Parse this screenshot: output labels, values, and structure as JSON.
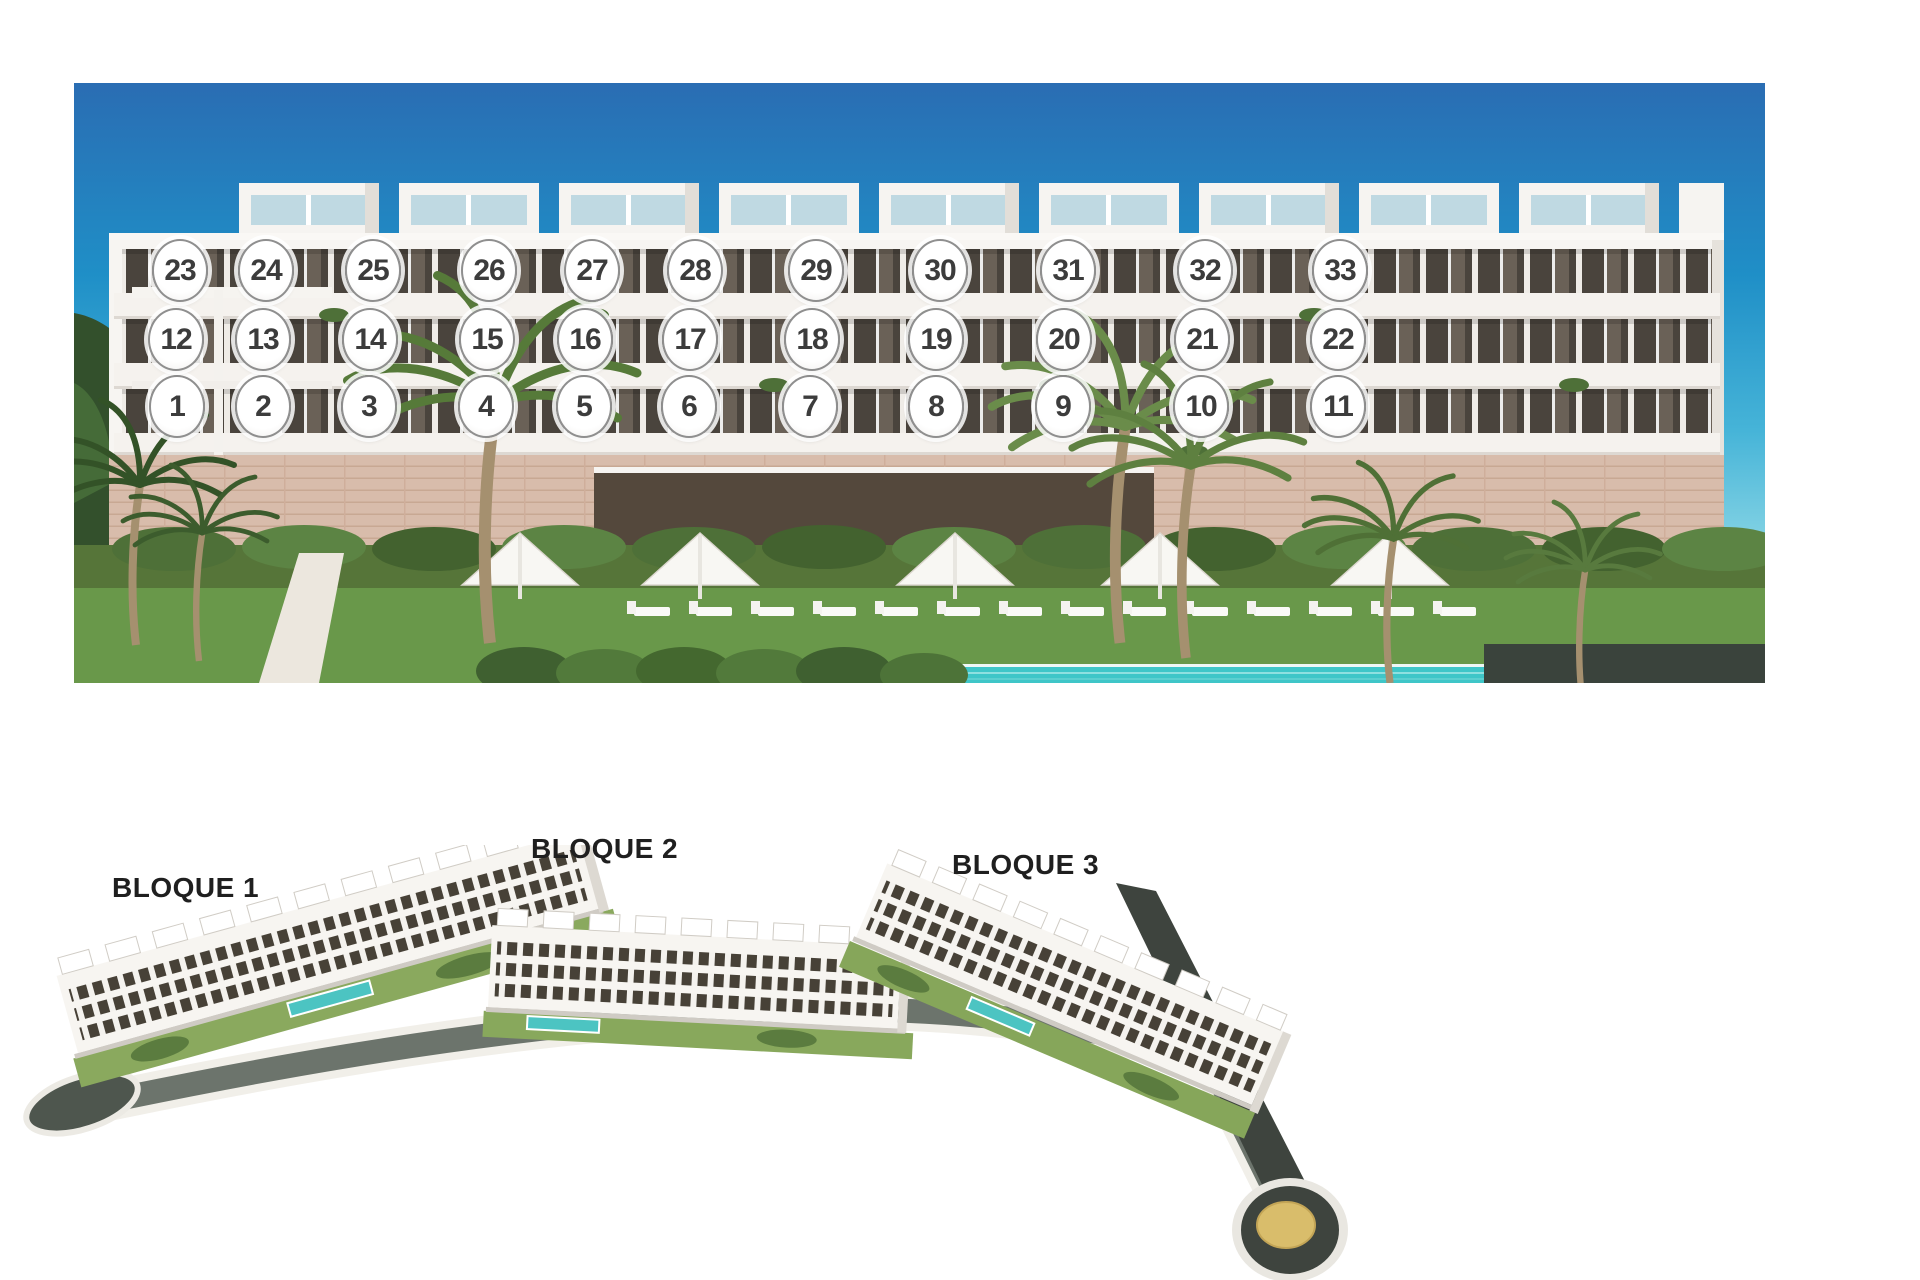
{
  "page": {
    "background_color": "#ffffff"
  },
  "front_elevation": {
    "description": "Front render of apartment block with numbered unit markers",
    "rows": {
      "top_floor_units": "23-33",
      "middle_floor_units": "12-22",
      "ground_floor_units": "1-11"
    },
    "units": [
      {
        "n": "1",
        "x": 177,
        "y": 407
      },
      {
        "n": "2",
        "x": 263,
        "y": 407
      },
      {
        "n": "3",
        "x": 369,
        "y": 407
      },
      {
        "n": "4",
        "x": 486,
        "y": 407
      },
      {
        "n": "5",
        "x": 584,
        "y": 407
      },
      {
        "n": "6",
        "x": 689,
        "y": 407
      },
      {
        "n": "7",
        "x": 810,
        "y": 407
      },
      {
        "n": "8",
        "x": 936,
        "y": 407
      },
      {
        "n": "9",
        "x": 1063,
        "y": 407
      },
      {
        "n": "10",
        "x": 1201,
        "y": 407
      },
      {
        "n": "11",
        "x": 1338,
        "y": 407
      },
      {
        "n": "12",
        "x": 176,
        "y": 340
      },
      {
        "n": "13",
        "x": 263,
        "y": 340
      },
      {
        "n": "14",
        "x": 370,
        "y": 340
      },
      {
        "n": "15",
        "x": 487,
        "y": 340
      },
      {
        "n": "16",
        "x": 585,
        "y": 340
      },
      {
        "n": "17",
        "x": 690,
        "y": 340
      },
      {
        "n": "18",
        "x": 812,
        "y": 340
      },
      {
        "n": "19",
        "x": 936,
        "y": 340
      },
      {
        "n": "20",
        "x": 1064,
        "y": 340
      },
      {
        "n": "21",
        "x": 1202,
        "y": 340
      },
      {
        "n": "22",
        "x": 1338,
        "y": 340
      },
      {
        "n": "23",
        "x": 180,
        "y": 271
      },
      {
        "n": "24",
        "x": 266,
        "y": 271
      },
      {
        "n": "25",
        "x": 373,
        "y": 271
      },
      {
        "n": "26",
        "x": 489,
        "y": 271
      },
      {
        "n": "27",
        "x": 592,
        "y": 271
      },
      {
        "n": "28",
        "x": 695,
        "y": 271
      },
      {
        "n": "29",
        "x": 816,
        "y": 271
      },
      {
        "n": "30",
        "x": 940,
        "y": 271
      },
      {
        "n": "31",
        "x": 1068,
        "y": 271
      },
      {
        "n": "32",
        "x": 1205,
        "y": 271
      },
      {
        "n": "33",
        "x": 1340,
        "y": 271
      }
    ]
  },
  "site_plan": {
    "description": "Aerial site rendering of three blocks along curved road with roundabout",
    "blocks": [
      {
        "label": "BLOQUE 1"
      },
      {
        "label": "BLOQUE 2"
      },
      {
        "label": "BLOQUE 3"
      }
    ]
  },
  "colors": {
    "sky_top": "#2a6db3",
    "sky_horizon": "#b9e7ec",
    "building_white": "#f7f5f2",
    "window_glass": "#4a443d",
    "stone_base": "#d8bcab",
    "lawn_green": "#69984a",
    "pool_turquoise": "#3fc6c8",
    "hedge_dark": "#3a433c",
    "road_asphalt": "#6c746c",
    "road_dark": "#3e443e",
    "roundabout_center": "#d9bd6b",
    "circle_border": "#8f8f8f",
    "number_color": "#3c3c3c",
    "label_color": "#1f1f1f"
  }
}
